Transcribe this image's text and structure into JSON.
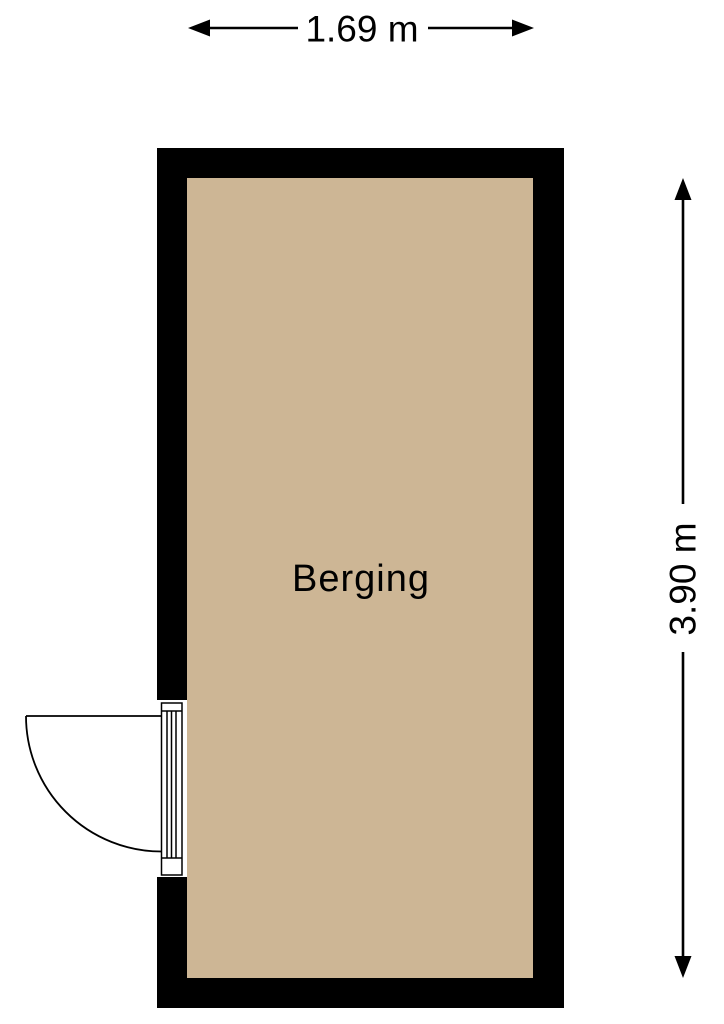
{
  "floorplan": {
    "room": {
      "label": "Berging"
    },
    "dimensions": {
      "width": {
        "label": "1.69 m",
        "meters": 1.69,
        "orientation": "horizontal",
        "position": "top"
      },
      "height": {
        "label": "3.90 m",
        "meters": 3.9,
        "orientation": "vertical",
        "position": "right"
      }
    },
    "door": {
      "type": "single-swing",
      "wall": "left",
      "swing": "outward"
    },
    "colors": {
      "wall": "#000000",
      "floor": "#CDB695",
      "line": "#000000",
      "text": "#000000",
      "background": "#FFFFFF"
    }
  }
}
